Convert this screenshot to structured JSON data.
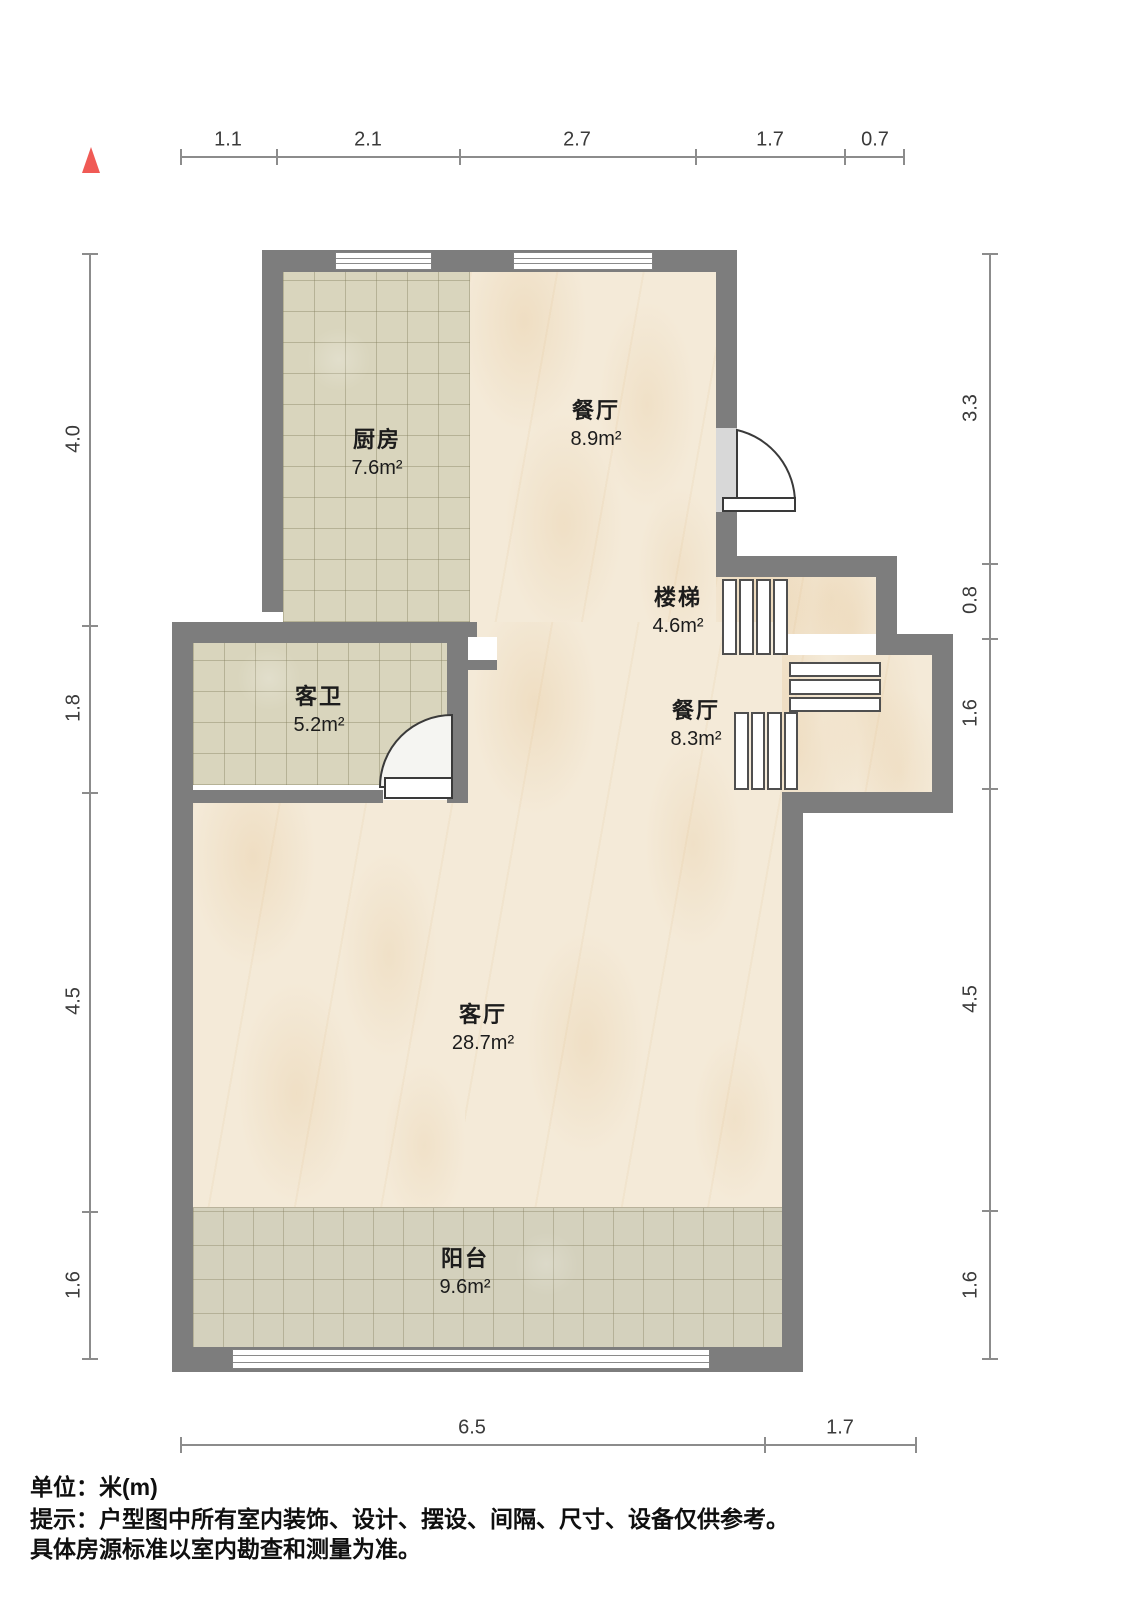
{
  "compass": {
    "icon": "north-triangle",
    "color": "#f05a55"
  },
  "dimensions": {
    "unit_per_label": "meters",
    "top": [
      "1.1",
      "2.1",
      "2.7",
      "1.7",
      "0.7"
    ],
    "left": [
      "4.0",
      "1.8",
      "4.5",
      "1.6"
    ],
    "right": [
      "3.3",
      "0.8",
      "1.6",
      "4.5",
      "1.6"
    ],
    "bottom": [
      "6.5",
      "1.7"
    ]
  },
  "rooms": {
    "kitchen": {
      "name": "厨房",
      "area": "7.6m²"
    },
    "dining_upper": {
      "name": "餐厅",
      "area": "8.9m²"
    },
    "stairs": {
      "name": "楼梯",
      "area": "4.6m²"
    },
    "dining_lower": {
      "name": "餐厅",
      "area": "8.3m²"
    },
    "guest_bath": {
      "name": "客卫",
      "area": "5.2m²"
    },
    "living": {
      "name": "客厅",
      "area": "28.7m²"
    },
    "balcony": {
      "name": "阳台",
      "area": "9.6m²"
    }
  },
  "footer": {
    "unit": "单位：米(m)",
    "tip1": "提示：户型图中所有室内装饰、设计、摆设、间隔、尺寸、设备仅供参考。",
    "tip2": "具体房源标准以室内勘查和测量为准。"
  },
  "colors": {
    "wall": "#7d7d7d",
    "marble_floor": "#f4ead8",
    "tile_floor": "#d9d5bd",
    "balcony_floor": "#d4d1bd",
    "accent_red": "#f05a55",
    "dimension_line": "#8c8c8c"
  }
}
